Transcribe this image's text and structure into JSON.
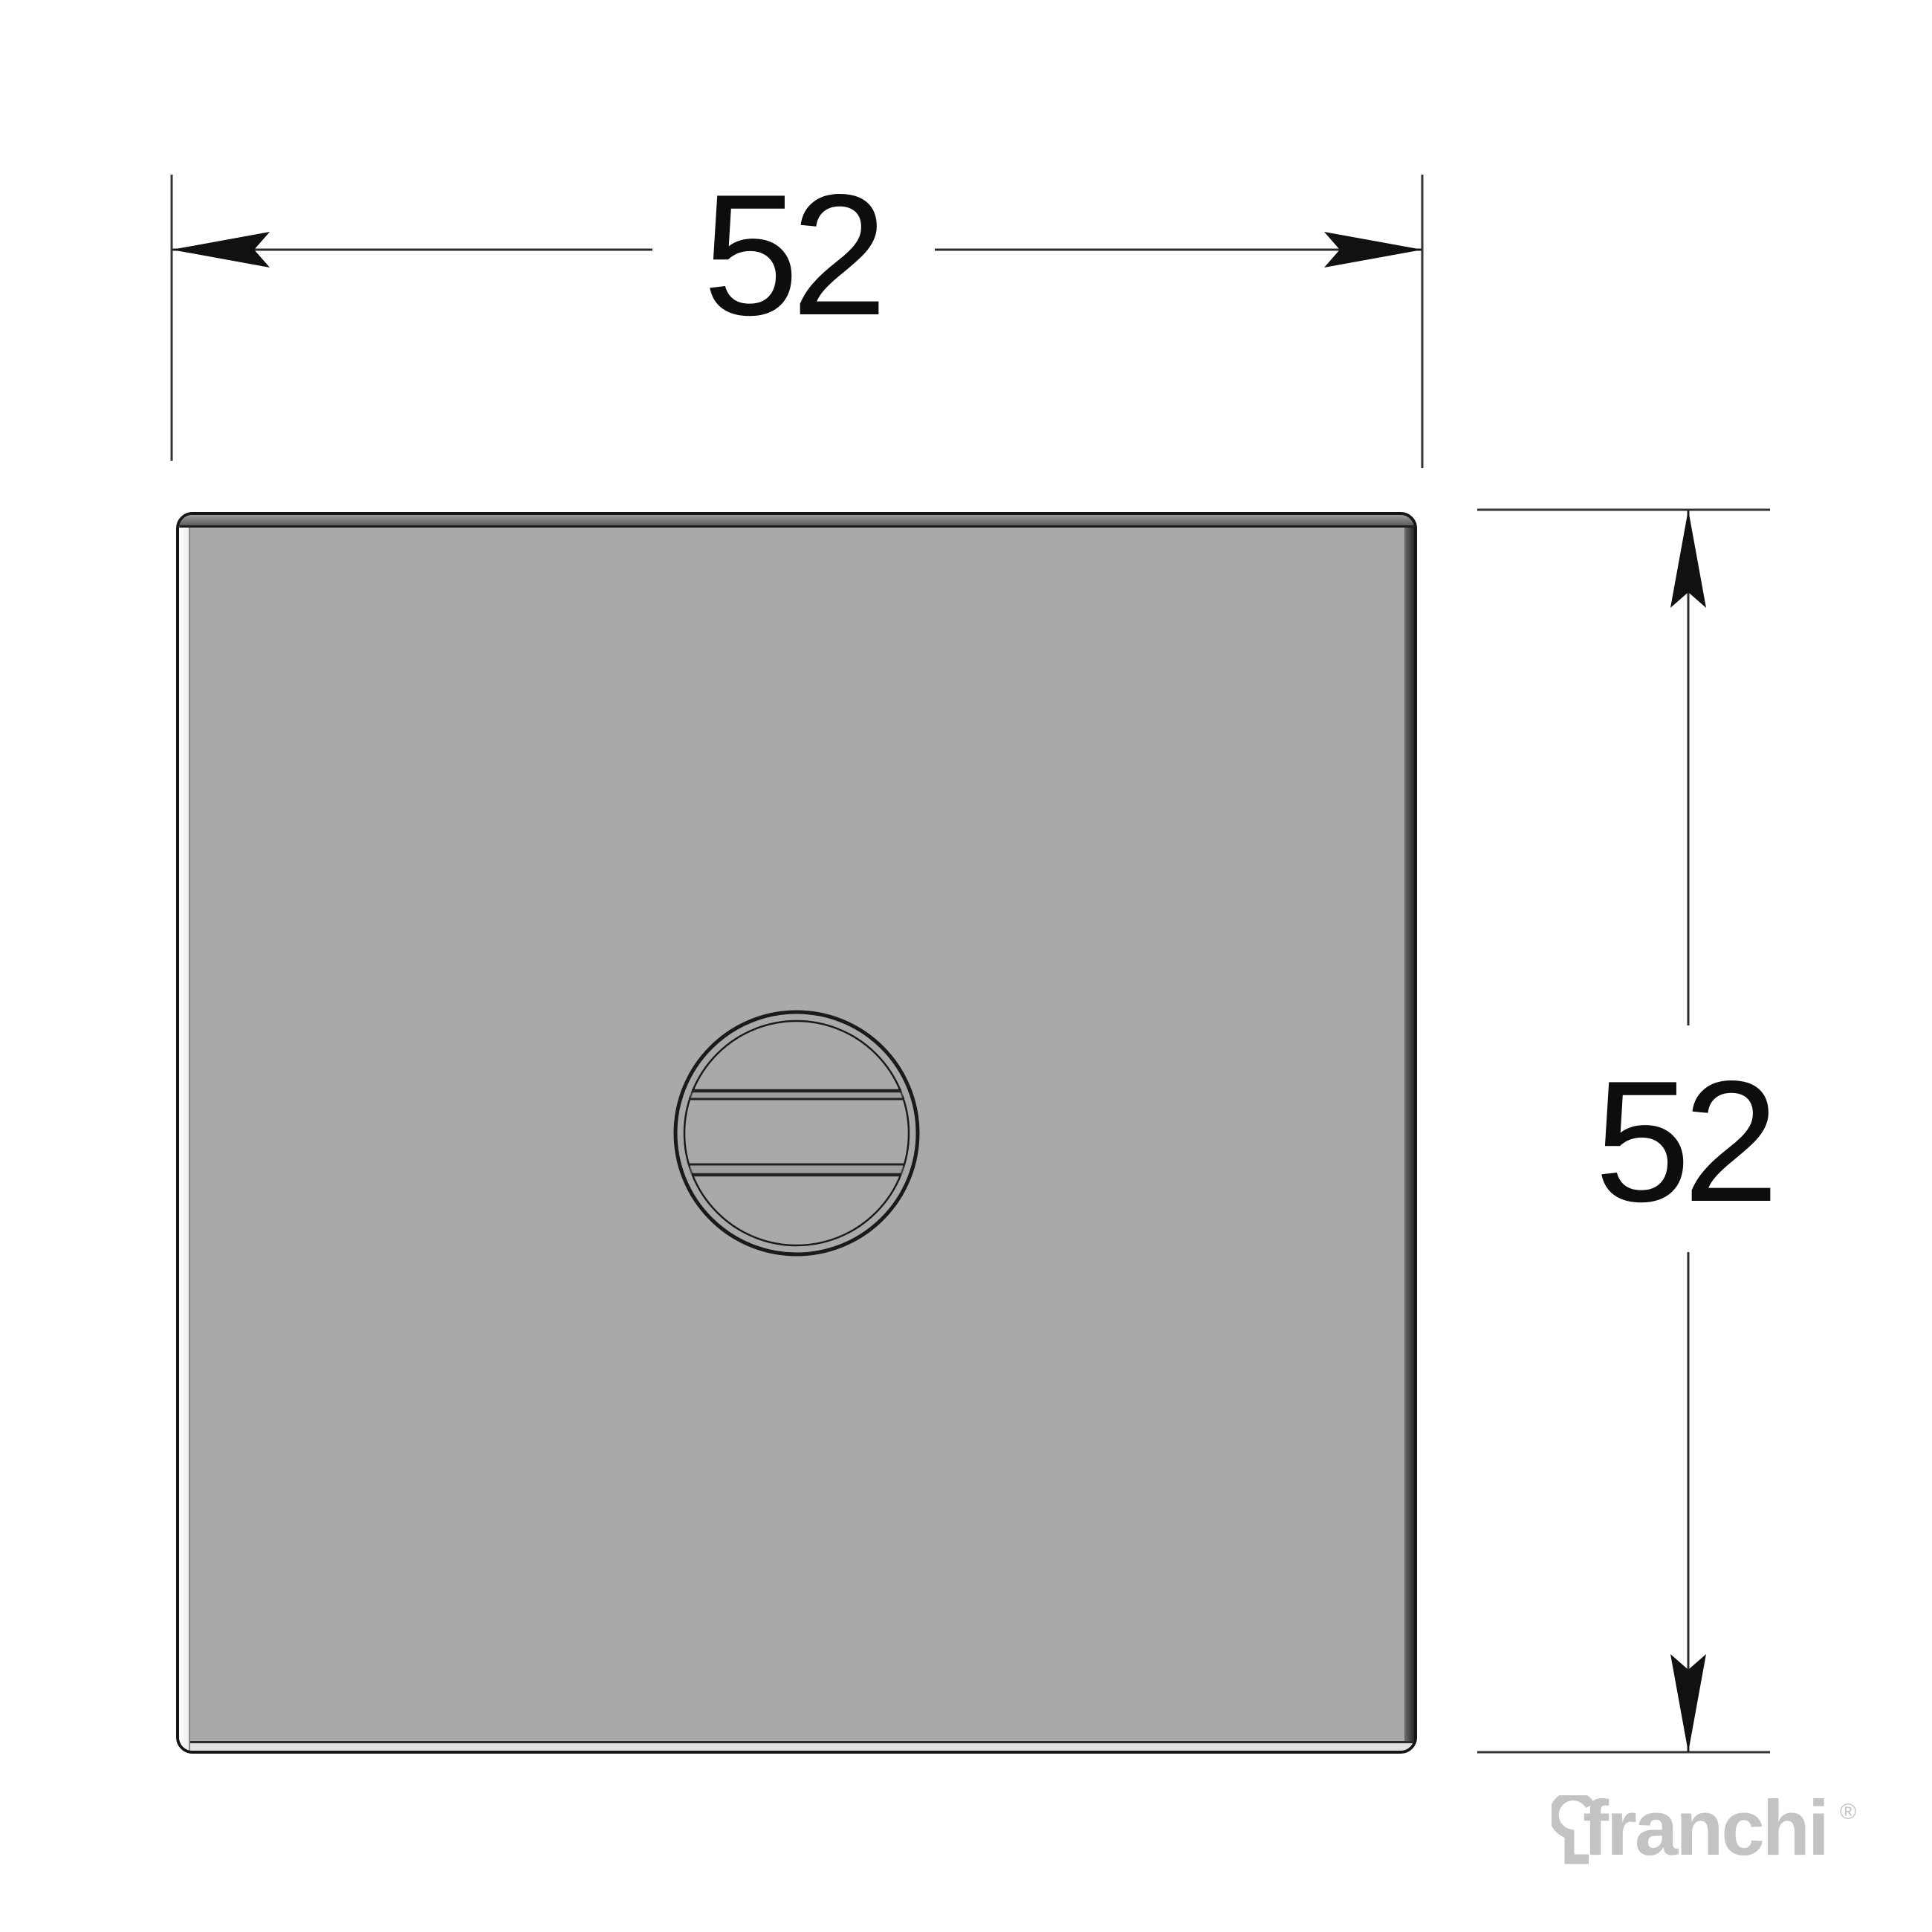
{
  "diagram": {
    "dimensions": {
      "width": {
        "label": "52"
      },
      "height": {
        "label": "52"
      }
    }
  },
  "logo": {
    "name": "franchi",
    "registered": "®"
  },
  "icons": {
    "keyhole": "keyhole-icon",
    "arrows": [
      "arrow-left-icon",
      "arrow-right-icon",
      "arrow-up-icon",
      "arrow-down-icon"
    ]
  },
  "colors": {
    "background": "#ffffff",
    "plate_face": "#a9a9a9",
    "plate_outline": "#151515",
    "dimension_lines": "#2b2b2b",
    "dimension_text": "#0d0d0d",
    "logo_gray": "#c3c3c3"
  }
}
